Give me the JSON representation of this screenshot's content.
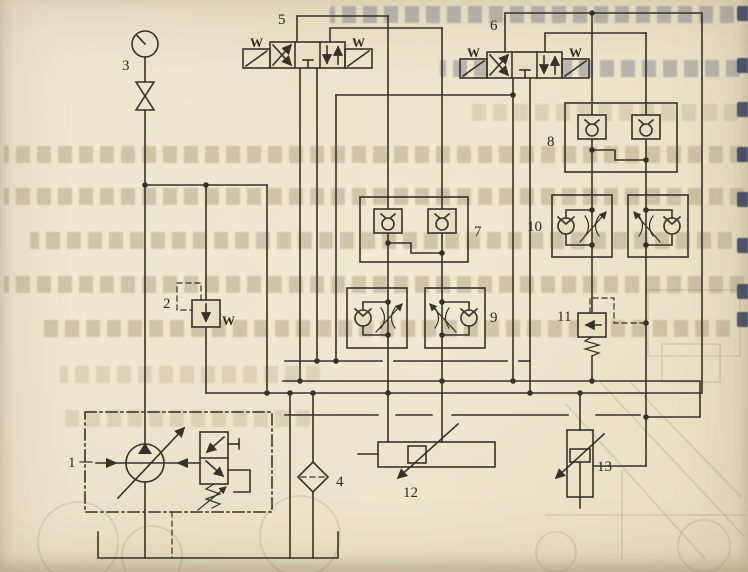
{
  "document": {
    "kind": "scanned textbook page with hydraulic circuit schematic",
    "orientation": "diagram over faded mirrored print bleed-through"
  },
  "colors": {
    "paper": "#e9e0c4",
    "ink": "#34322a",
    "ghost_text": "#8b7d5a",
    "edge_marks": "#2e3a56"
  },
  "labels": {
    "c1": "1",
    "c2": "2",
    "c3": "3",
    "c4": "4",
    "c5": "5",
    "c6": "6",
    "c7": "7",
    "c8": "8",
    "c9": "9",
    "c10": "10",
    "c11": "11",
    "c12": "12",
    "c13": "13",
    "spring": "W"
  },
  "components": {
    "1": "variable displacement pump unit with compensator (dash-dot enclosure)",
    "2": "pilot relief valve with spring",
    "3": "pressure gauge with shutoff valve",
    "4": "return filter",
    "5": "4/3 solenoid directional valve, spring centered",
    "6": "4/3 solenoid directional valve, spring centered",
    "7": "dual pilot-operated check valve block (hydraulic lock)",
    "8": "dual pilot-operated check valve block (hydraulic lock)",
    "9": "pair of one-way throttle valves",
    "10": "pair of one-way throttle valves",
    "11": "sequence valve with remote pilot (dashed)",
    "12": "horizontal cylinder, adjustable",
    "13": "vertical cylinder, adjustable"
  }
}
